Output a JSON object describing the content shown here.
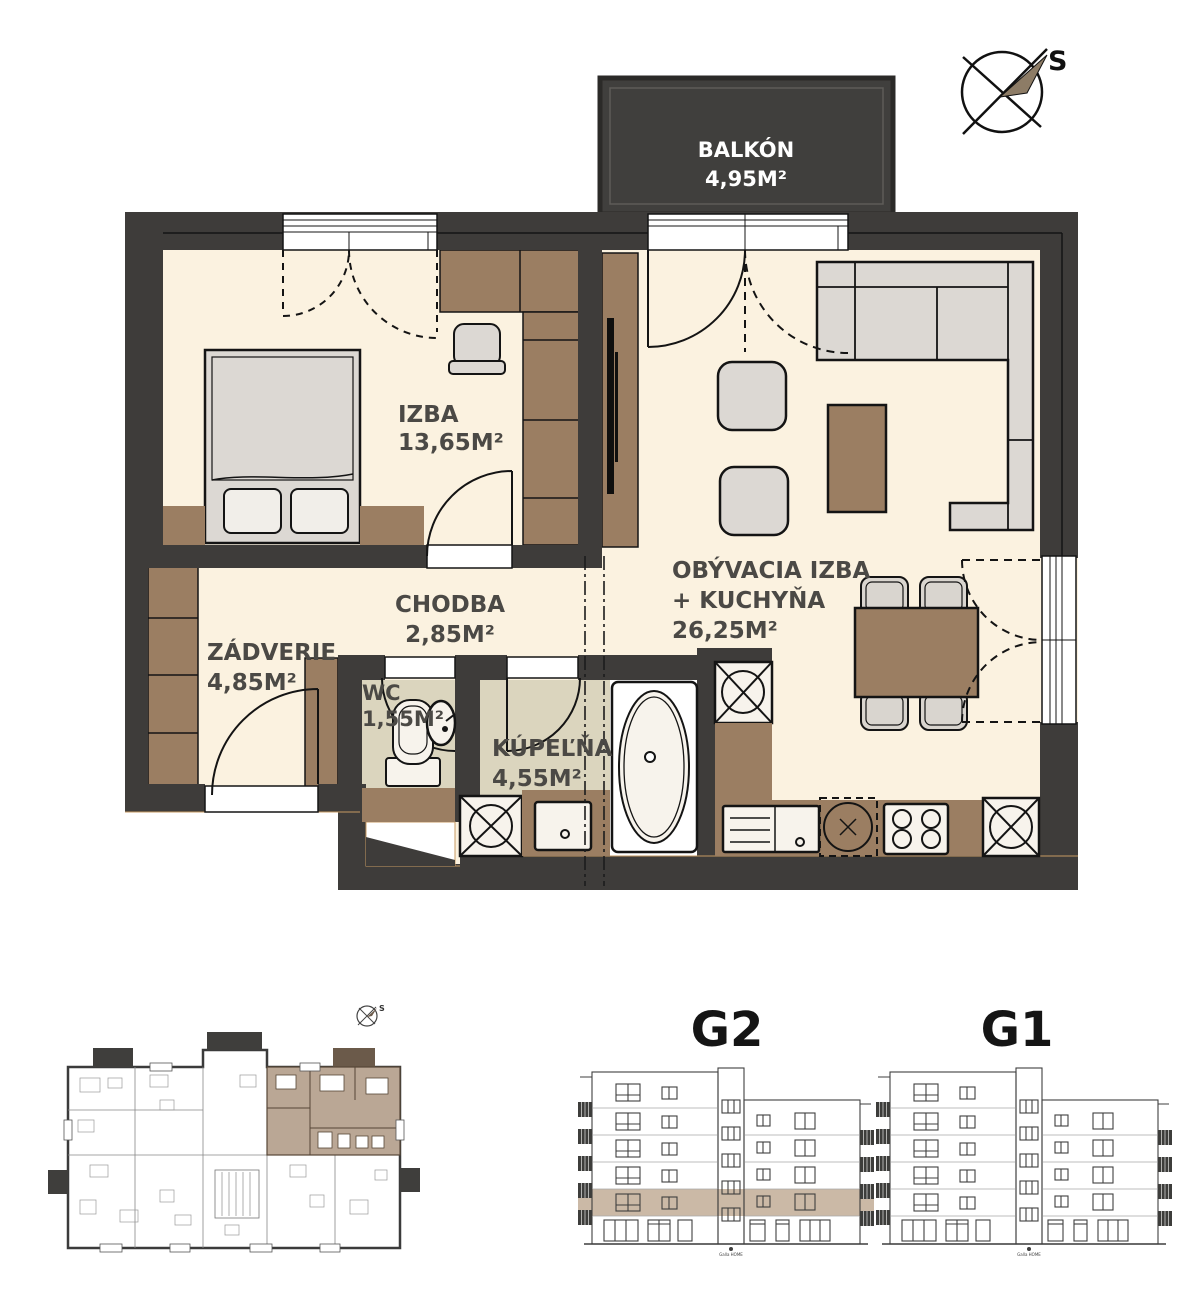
{
  "floorplan": {
    "balcony": {
      "name": "BALKÓN",
      "area": "4,95M²"
    },
    "compass": {
      "label": "S"
    },
    "rooms": {
      "izba": {
        "name": "IZBA",
        "area": "13,65M²"
      },
      "living": {
        "name_line1": "OBÝVACIA IZBA",
        "name_line2": "+ KUCHYŇA",
        "area": "26,25M²"
      },
      "chodba": {
        "name": "CHODBA",
        "area": "2,85M²"
      },
      "zadverie": {
        "name": "ZÁDVERIE",
        "area": "4,85M²"
      },
      "wc": {
        "name": "WC",
        "area": "1,55M²"
      },
      "kupelna": {
        "name": "KÚPEĽŇA",
        "area": "4,55M²"
      }
    }
  },
  "overview": {
    "compass_label": "S"
  },
  "elevations": [
    {
      "label": "G2"
    },
    {
      "label": "G1"
    }
  ],
  "logo_text": "Galla HOME",
  "colors": {
    "wall": "#3E3C3A",
    "floor_cream": "#FBF2E0",
    "tile_beige": "#DBD5BE",
    "furniture_brown": "#9B7E62",
    "furniture_gray": "#DCD8D3",
    "balcony_fill": "#403F3D",
    "label_text": "#4B4945",
    "overview_highlight": "#BAA795",
    "elevation_highlight": "#CBB9A6",
    "accent_hairline": "#C79A62"
  }
}
